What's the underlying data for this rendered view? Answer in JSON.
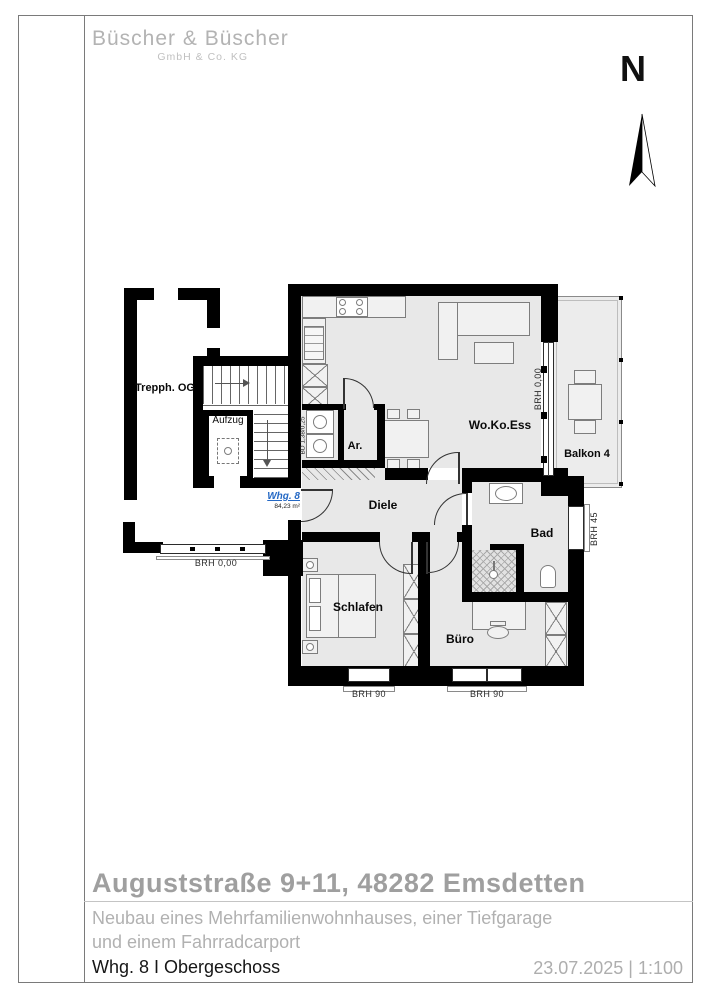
{
  "sheet": {
    "logo_line1": "Büscher & Büscher",
    "logo_line2": "GmbH & Co. KG",
    "north_label": "N"
  },
  "plan": {
    "labels": {
      "stairwell": "Trepph. OG",
      "elevator": "Aufzug",
      "storage": "Ar.",
      "living": "Wo.Ko.Ess",
      "balcony": "Balkon 4",
      "hall": "Diele",
      "bath": "Bad",
      "bedroom": "Schlafen",
      "office": "Büro",
      "apartment_id": "Whg. 8",
      "apartment_area": "84,23 m²"
    },
    "annotations": {
      "balcony_window": "BRH 0,00",
      "left_window": "BRH 0,00",
      "bath_window": "BRH 45",
      "bedroom_window": "BRH 90",
      "office_window": "BRH 90",
      "duct": "BD 1,38/0,25"
    }
  },
  "titleblock": {
    "title": "Auguststraße 9+11, 48282 Emsdetten",
    "subtitle_line1": "Neubau eines Mehrfamilienwohnhauses, einer Tiefgarage",
    "subtitle_line2": "und einem Fahrradcarport",
    "sheet_name": "Whg. 8 I Obergeschoss",
    "date_scale": "23.07.2025  |  1:100"
  },
  "colors": {
    "wall": "#000000",
    "floor": "#e8e8e8",
    "accent_blue": "#2468c4",
    "title_gray": "#9f9f9f"
  }
}
